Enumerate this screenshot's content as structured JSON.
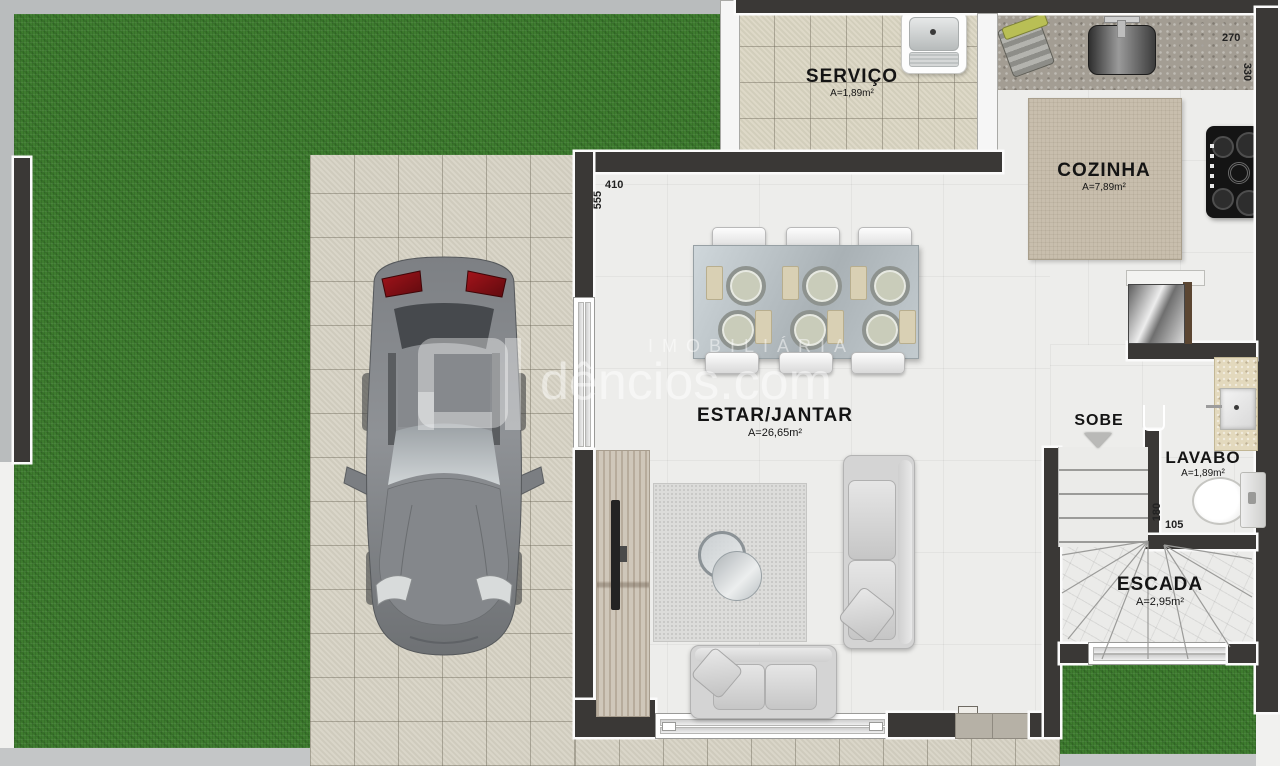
{
  "plan_title": "Ground floor plan (pavimento térreo)",
  "watermark": {
    "brand_small": "IMOBILIÁRIA",
    "brand_big": "dêncios.com"
  },
  "rooms": {
    "servico": {
      "name": "SERVIÇO",
      "area": "A=1,89m²"
    },
    "cozinha": {
      "name": "COZINHA",
      "area": "A=7,89m²"
    },
    "estar_jantar": {
      "name": "ESTAR/JANTAR",
      "area": "A=26,65m²"
    },
    "sobe": {
      "name": "SOBE"
    },
    "lavabo": {
      "name": "LAVABO",
      "area": "A=1,89m²"
    },
    "escada": {
      "name": "ESCADA",
      "area": "A=2,95m²"
    }
  },
  "dimensions_cm": {
    "kitchen_width": "270",
    "kitchen_depth": "330",
    "living_width": "410",
    "living_depth": "555",
    "lavabo_depth": "180",
    "lavabo_width": "105"
  },
  "colors": {
    "grass": "#3e7c2f",
    "wall": "#3a3836",
    "driveway_tile": "#d7d3c5",
    "interior_floor": "#ededeb",
    "counter_granite": "#a39d93",
    "island_top": "#c8bead",
    "taillight_red": "#8a1016"
  }
}
